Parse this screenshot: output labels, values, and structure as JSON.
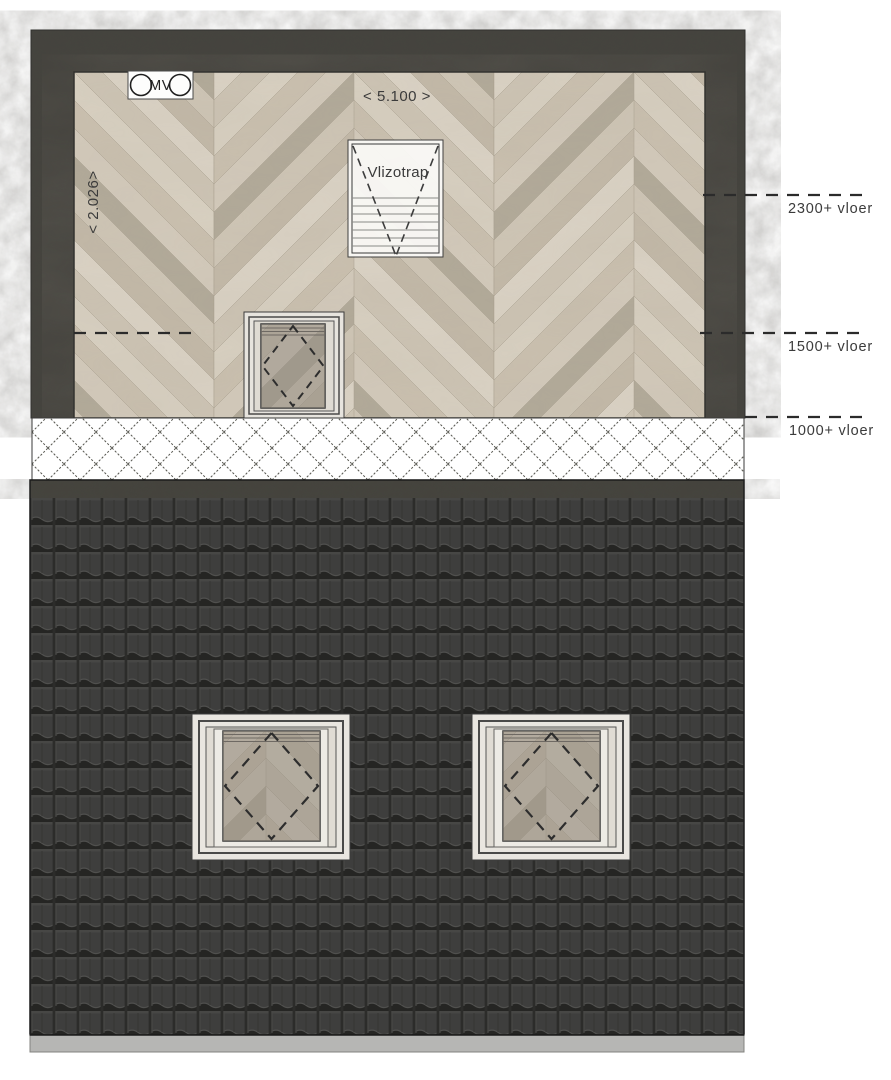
{
  "drawing": {
    "mv_symbol": {
      "label": "MV"
    },
    "dimensions": {
      "width_label": "< 5.100 >",
      "depth_label": "< 2.026>"
    },
    "stair": {
      "label": "Vlizotrap"
    },
    "level_lines": [
      {
        "label": "2300+ vloer"
      },
      {
        "label": "1500+ vloer"
      },
      {
        "label": "1000+ vloer"
      }
    ],
    "colors": {
      "wall": "#45443f",
      "floor_wood_base": "#cfc6b6",
      "roof_tiles": "#3e3e3d",
      "roof_ridge": "#45443e",
      "gutter": "#b6b6b4",
      "window_frame": "#e9e6e0",
      "glass_tint": "#938d82",
      "annotation_line": "#2b2b2b"
    }
  }
}
